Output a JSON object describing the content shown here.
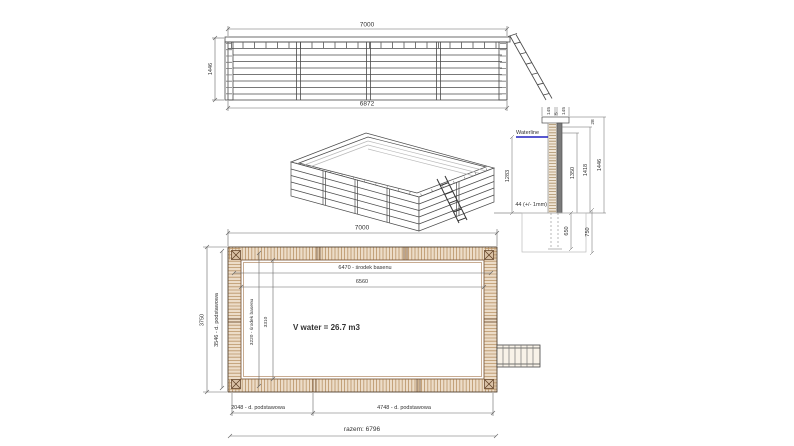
{
  "drawing_type": "wooden pool technical drawing (elevation, isometric, wall section, plan)",
  "colors": {
    "line": "#4a4a4a",
    "dim_line": "#666666",
    "wood_fill": "#ecdcc8",
    "wood_hatch": "#b08a5e",
    "wood_dark": "#6f4a28",
    "waterline_blue": "#2020c0",
    "steel_gray": "#7a7a7a",
    "ground_gray": "#bbbbbb"
  },
  "elevation": {
    "width_top": "7000",
    "height_left": "1446",
    "width_bottom": "6872"
  },
  "section": {
    "cap_left": "145",
    "cap_gap": "5",
    "cap_right": "145",
    "waterline": "Waterline",
    "depth": "1283",
    "thickness": "44 (+/- 1mm)",
    "h_inner": "1350",
    "h_mid": "1418",
    "h_total": "1446",
    "top_offset": "28",
    "below_650": "650",
    "below_750": "750"
  },
  "plan": {
    "width_top": "7000",
    "center_len": "6470 - środek basenu",
    "inner_len": "6560",
    "height_total": "3750",
    "board_left": "3546 - d. podstawowa",
    "center_wid": "3220 - środek basenu",
    "inner_wid": "3310",
    "volume": "V water = 26.7 m3",
    "board_bottom_left": "2048 - d. podstawowa",
    "board_bottom_right": "4748 - d. podstawowa",
    "total_bottom": "razem: 6796"
  }
}
